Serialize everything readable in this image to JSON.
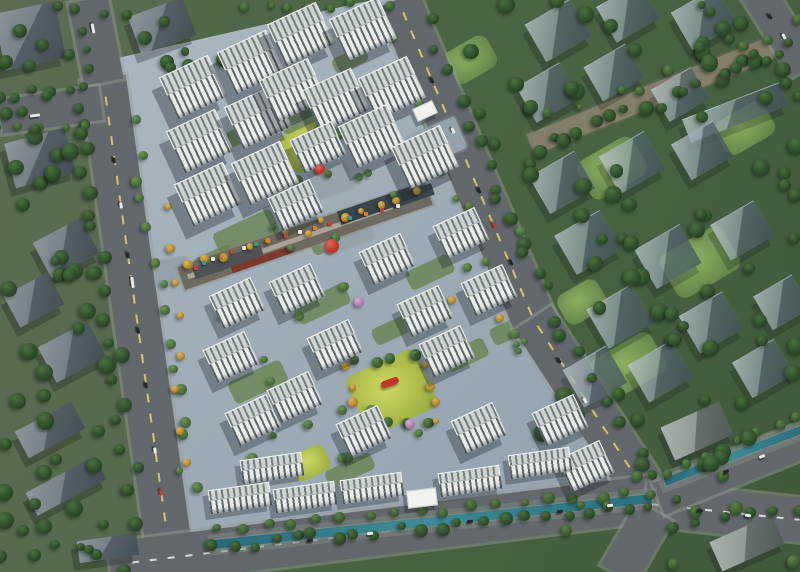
{
  "meta": {
    "description": "Aerial rendering of a residential development masterplan with white apartment towers, retail street, canal and surrounding city blocks"
  },
  "palette": {
    "tree": {
      "dark": {
        "hi": "#4c7040",
        "base": "#2f4e2b",
        "lo": "#1e351d"
      },
      "mid": {
        "hi": "#5d8148",
        "base": "#3d5e33",
        "lo": "#27431f"
      },
      "site": {
        "hi": "#6f9355",
        "base": "#4a6e3c",
        "lo": "#2f4c28"
      },
      "yellow": {
        "hi": "#dcb657",
        "base": "#b68a2e",
        "lo": "#7e5c1d"
      },
      "pink": {
        "hi": "#d8aed4",
        "base": "#b07fae",
        "lo": "#7e577d"
      }
    },
    "accent_red": "#c2382c",
    "water": "#2e7380",
    "paving": "#9dabb6",
    "road": "#63686c"
  },
  "scene": {
    "width": 800,
    "height": 572,
    "roads": [
      [
        135,
        309,
        467,
        46,
        82,
        1
      ],
      [
        96,
        41,
        84,
        40,
        79,
        0
      ],
      [
        50,
        110,
        101,
        34,
        -8,
        0
      ],
      [
        468,
        165,
        360,
        44,
        67,
        1
      ],
      [
        595,
        415,
        231,
        44,
        57,
        1
      ],
      [
        380,
        532,
        544,
        46,
        -7,
        2
      ],
      [
        725,
        512,
        161,
        44,
        6,
        2
      ],
      [
        636,
        543,
        73,
        40,
        -60,
        0
      ],
      [
        730,
        470,
        155,
        34,
        -22,
        0
      ],
      [
        780,
        28,
        96,
        34,
        58,
        0
      ]
    ],
    "canals": [
      [
        432,
        520,
        440,
        9,
        -6
      ],
      [
        732,
        455,
        146,
        8,
        -21
      ]
    ],
    "greenways": [
      [
        666,
        90,
        292,
        22,
        -22
      ]
    ],
    "prisms": [
      [
        558,
        30,
        52,
        42,
        -30,
        "t"
      ],
      [
        628,
        12,
        50,
        40,
        -30,
        "t"
      ],
      [
        704,
        18,
        52,
        42,
        -30,
        "t"
      ],
      [
        548,
        92,
        50,
        40,
        -30,
        "t"
      ],
      [
        614,
        72,
        48,
        38,
        -30,
        "t"
      ],
      [
        680,
        94,
        46,
        36,
        -30,
        "t"
      ],
      [
        735,
        112,
        104,
        24,
        -21,
        "t"
      ],
      [
        562,
        182,
        52,
        42,
        -30,
        "t"
      ],
      [
        632,
        162,
        52,
        42,
        -30,
        "t"
      ],
      [
        702,
        150,
        48,
        40,
        -30,
        "t"
      ],
      [
        588,
        242,
        52,
        44,
        -30,
        "t"
      ],
      [
        668,
        256,
        52,
        44,
        -30,
        "t"
      ],
      [
        742,
        230,
        50,
        40,
        -30,
        "t"
      ],
      [
        620,
        316,
        52,
        44,
        -30,
        "t"
      ],
      [
        711,
        322,
        50,
        42,
        -30,
        "t"
      ],
      [
        782,
        302,
        44,
        38,
        -30,
        "t"
      ],
      [
        595,
        376,
        50,
        42,
        -30,
        "t"
      ],
      [
        660,
        371,
        50,
        42,
        -30,
        "t"
      ],
      [
        763,
        368,
        48,
        40,
        -30,
        "t"
      ],
      [
        697,
        431,
        64,
        36,
        -24,
        "g"
      ],
      [
        747,
        543,
        68,
        32,
        -24,
        "g"
      ],
      [
        30,
        36,
        62,
        58,
        -12,
        "s"
      ],
      [
        162,
        26,
        58,
        40,
        -20,
        "s"
      ],
      [
        40,
        158,
        62,
        46,
        -15,
        "s"
      ],
      [
        66,
        248,
        54,
        40,
        -28,
        "s"
      ],
      [
        34,
        300,
        50,
        36,
        -28,
        "s"
      ],
      [
        72,
        352,
        56,
        40,
        -28,
        "s"
      ],
      [
        50,
        430,
        64,
        30,
        -28,
        "s"
      ],
      [
        66,
        486,
        78,
        26,
        -28,
        "s"
      ],
      [
        108,
        548,
        60,
        22,
        -8,
        "s"
      ]
    ],
    "towers": [
      [
        193,
        87,
        0
      ],
      [
        200,
        141,
        0
      ],
      [
        208,
        194,
        0
      ],
      [
        251,
        62,
        0
      ],
      [
        258,
        117,
        0
      ],
      [
        265,
        173,
        0
      ],
      [
        301,
        34,
        0
      ],
      [
        363,
        29,
        0
      ],
      [
        293,
        90,
        0
      ],
      [
        336,
        100,
        0
      ],
      [
        392,
        88,
        0
      ],
      [
        372,
        136,
        0
      ],
      [
        425,
        157,
        0
      ],
      [
        318,
        147,
        1
      ],
      [
        296,
        205,
        1
      ],
      [
        387,
        259,
        1
      ],
      [
        297,
        289,
        1
      ],
      [
        461,
        233,
        1
      ],
      [
        489,
        290,
        1
      ],
      [
        425,
        311,
        1
      ],
      [
        335,
        345,
        1
      ],
      [
        295,
        397,
        1
      ],
      [
        364,
        431,
        1
      ],
      [
        447,
        351,
        1
      ],
      [
        479,
        428,
        1
      ],
      [
        237,
        303,
        1
      ],
      [
        231,
        357,
        1
      ],
      [
        253,
        420,
        1
      ],
      [
        560,
        420,
        1
      ],
      [
        586,
        466,
        1
      ],
      [
        272,
        468,
        2
      ],
      [
        305,
        497,
        2
      ],
      [
        372,
        488,
        2
      ],
      [
        470,
        481,
        2
      ],
      [
        540,
        463,
        2
      ],
      [
        240,
        498,
        2
      ]
    ],
    "gates": [
      [
        424,
        110,
        20,
        12,
        -25
      ],
      [
        421,
        497,
        28,
        16,
        -7
      ]
    ],
    "lawns_site": [
      [
        309,
        146,
        48,
        42,
        -25
      ],
      [
        392,
        392,
        76,
        64,
        -25
      ],
      [
        310,
        463,
        38,
        28,
        -25
      ]
    ],
    "lawns_ctx": [
      [
        612,
        168,
        64,
        44,
        -30
      ],
      [
        700,
        262,
        72,
        50,
        -30
      ],
      [
        628,
        366,
        70,
        46,
        -30
      ],
      [
        745,
        128,
        56,
        38,
        -30
      ],
      [
        470,
        60,
        50,
        36,
        -30
      ],
      [
        582,
        302,
        46,
        34,
        -30
      ]
    ],
    "courts": [
      [
        246,
        233,
        64,
        26
      ],
      [
        322,
        304,
        56,
        22
      ],
      [
        258,
        382,
        58,
        24
      ],
      [
        430,
        272,
        48,
        20
      ],
      [
        392,
        330,
        40,
        18
      ],
      [
        466,
        355,
        44,
        20
      ],
      [
        330,
        240,
        40,
        18
      ],
      [
        510,
        330,
        40,
        18
      ],
      [
        214,
        260,
        40,
        18
      ],
      [
        350,
        470,
        50,
        18
      ],
      [
        300,
        120,
        40,
        16
      ],
      [
        440,
        120,
        36,
        16
      ],
      [
        350,
        60,
        36,
        16
      ],
      [
        230,
        140,
        36,
        16
      ]
    ],
    "plazas": [
      [
        172,
        272,
        34,
        26,
        -8
      ],
      [
        345,
        232,
        52,
        32,
        -19
      ],
      [
        437,
        142,
        34,
        52,
        67
      ],
      [
        330,
        180,
        40,
        30,
        -19
      ]
    ],
    "street": {
      "band": [
        305,
        236,
        262,
        24,
        -19
      ],
      "walk": [
        305,
        236,
        248,
        5,
        -19
      ],
      "podiums": [
        [
          378,
          205,
          82,
          14,
          -19,
          "#3a464d"
        ],
        [
          228,
          262,
          72,
          12,
          -19,
          "#4e5358"
        ],
        [
          262,
          259,
          64,
          7,
          -19,
          "#7b3a2c"
        ],
        [
          412,
          196,
          44,
          12,
          -19,
          "#3a464d"
        ]
      ],
      "stalls": [
        [
          196,
          268,
          "#c04438"
        ],
        [
          204,
          263,
          "#2a9d8f"
        ],
        [
          213,
          259,
          "#e8e4da"
        ],
        [
          222,
          256,
          "#d98032"
        ],
        [
          232,
          252,
          "#c04438"
        ],
        [
          244,
          248,
          "#e8e4da"
        ],
        [
          256,
          244,
          "#2a9d8f"
        ],
        [
          268,
          241,
          "#d98032"
        ],
        [
          286,
          236,
          "#c04438"
        ],
        [
          300,
          232,
          "#e8e4da"
        ],
        [
          315,
          228,
          "#d98032"
        ],
        [
          330,
          224,
          "#c04438"
        ],
        [
          350,
          218,
          "#2a9d8f"
        ],
        [
          366,
          214,
          "#d98032"
        ],
        [
          382,
          210,
          "#c04438"
        ],
        [
          398,
          206,
          "#e8e4da"
        ]
      ]
    },
    "tree_bands": [
      [
        210,
        547,
        650,
        507,
        22,
        "dark",
        4,
        7,
        5
      ],
      [
        215,
        530,
        652,
        492,
        18,
        "mid",
        3.5,
        6,
        4
      ],
      [
        664,
        472,
        798,
        420,
        8,
        "mid",
        3.5,
        6,
        4
      ],
      [
        672,
        524,
        800,
        510,
        6,
        "dark",
        4,
        6,
        4
      ],
      [
        80,
        100,
        136,
        515,
        20,
        "dark",
        5,
        8,
        9
      ],
      [
        135,
        125,
        190,
        495,
        15,
        "site",
        3.5,
        6,
        8
      ],
      [
        429,
        25,
        566,
        340,
        14,
        "dark",
        4,
        7,
        7
      ],
      [
        390,
        35,
        518,
        332,
        10,
        "site",
        3,
        5,
        6
      ],
      [
        575,
        350,
        672,
        498,
        7,
        "dark",
        4,
        6,
        5
      ],
      [
        536,
        150,
        792,
        48,
        18,
        "dark",
        4,
        8,
        7
      ],
      [
        556,
        120,
        796,
        22,
        9,
        "mid",
        3,
        6,
        8
      ],
      [
        248,
        8,
        392,
        4,
        8,
        "mid",
        3,
        5,
        4
      ],
      [
        0,
        96,
        84,
        90,
        6,
        "dark",
        4,
        6,
        4
      ],
      [
        0,
        130,
        84,
        124,
        5,
        "mid",
        3,
        5,
        4
      ],
      [
        700,
        2,
        798,
        96,
        7,
        "dark",
        4,
        7,
        6
      ],
      [
        190,
        266,
        420,
        192,
        13,
        "yellow",
        3,
        5,
        5
      ],
      [
        170,
        210,
        184,
        465,
        8,
        "yellow",
        3,
        4.5,
        5
      ],
      [
        76,
        6,
        92,
        72,
        4,
        "dark",
        3.5,
        5.5,
        4
      ],
      [
        352,
        358,
        434,
        362,
        5,
        "mid",
        4,
        6,
        6
      ],
      [
        352,
        428,
        430,
        424,
        5,
        "mid",
        4,
        6,
        5
      ],
      [
        346,
        368,
        356,
        420,
        4,
        "yellow",
        3,
        5,
        4
      ],
      [
        428,
        368,
        436,
        420,
        4,
        "yellow",
        3,
        5,
        4
      ]
    ],
    "tree_patches": [
      [
        0,
        86,
        116,
        468,
        38,
        "dark",
        5,
        9
      ],
      [
        0,
        0,
        238,
        74,
        16,
        "dark",
        4,
        8
      ],
      [
        452,
        0,
        346,
        118,
        22,
        "dark",
        5,
        9
      ],
      [
        492,
        132,
        306,
        186,
        28,
        "dark",
        5,
        9
      ],
      [
        540,
        302,
        258,
        176,
        24,
        "dark",
        5,
        9
      ],
      [
        560,
        472,
        238,
        96,
        9,
        "mid",
        4,
        7
      ],
      [
        210,
        62,
        256,
        372,
        20,
        "site",
        3,
        5.5
      ],
      [
        252,
        380,
        214,
        106,
        12,
        "site",
        3,
        5.5
      ],
      [
        432,
        200,
        116,
        176,
        9,
        "site",
        3,
        5
      ],
      [
        284,
        114,
        58,
        62,
        6,
        "mid",
        3.5,
        5.5
      ],
      [
        0,
        516,
        128,
        54,
        8,
        "dark",
        4,
        7
      ]
    ],
    "trees_explicit": [
      [
        359,
        302,
        5,
        "pink"
      ],
      [
        410,
        424,
        5,
        "pink"
      ],
      [
        385,
        137,
        4.5,
        "pink"
      ],
      [
        296,
        468,
        4,
        "yellow"
      ],
      [
        452,
        300,
        4,
        "yellow"
      ],
      [
        500,
        318,
        4,
        "yellow"
      ]
    ],
    "sculptures": {
      "balls": [
        [
          332,
          246,
          7
        ],
        [
          320,
          169,
          5
        ]
      ],
      "ribbons": [
        [
          390,
          382,
          18,
          7,
          -20
        ]
      ]
    },
    "cars": [
      [
        114,
        160,
        82,
        6,
        "#23282c"
      ],
      [
        121,
        205,
        82,
        6,
        "#e8e8e8"
      ],
      [
        128,
        255,
        82,
        6,
        "#23282c"
      ],
      [
        132,
        282,
        82,
        11,
        "#e8e8e8"
      ],
      [
        138,
        330,
        82,
        6,
        "#23282c"
      ],
      [
        146,
        385,
        82,
        6,
        "#23282c"
      ],
      [
        155,
        450,
        82,
        6,
        "#e8e8e8"
      ],
      [
        161,
        492,
        82,
        6,
        "#c03a2e"
      ],
      [
        432,
        80,
        67,
        6,
        "#23282c"
      ],
      [
        453,
        130,
        67,
        6,
        "#e8e8e8"
      ],
      [
        479,
        190,
        67,
        6,
        "#23282c"
      ],
      [
        494,
        225,
        67,
        7,
        "#c03a2e"
      ],
      [
        511,
        262,
        67,
        6,
        "#23282c"
      ],
      [
        559,
        360,
        57,
        6,
        "#23282c"
      ],
      [
        585,
        400,
        57,
        6,
        "#e8e8e8"
      ],
      [
        310,
        540,
        -7,
        6,
        "#23282c"
      ],
      [
        370,
        533,
        -7,
        6,
        "#e8e8e8"
      ],
      [
        470,
        521,
        -7,
        6,
        "#23282c"
      ],
      [
        560,
        511,
        -7,
        6,
        "#23282c"
      ],
      [
        610,
        505,
        -7,
        6,
        "#e8e8e8"
      ],
      [
        700,
        510,
        6,
        6,
        "#23282c"
      ],
      [
        748,
        515,
        6,
        6,
        "#e8e8e8"
      ],
      [
        726,
        471,
        -22,
        6,
        "#23282c"
      ],
      [
        762,
        456,
        -22,
        6,
        "#e8e8e8"
      ],
      [
        770,
        16,
        58,
        6,
        "#23282c"
      ],
      [
        784,
        36,
        58,
        6,
        "#e8e8e8"
      ],
      [
        93,
        28,
        79,
        10,
        "#e8e8e8"
      ],
      [
        35,
        115,
        -8,
        10,
        "#e8e8e8"
      ]
    ]
  }
}
